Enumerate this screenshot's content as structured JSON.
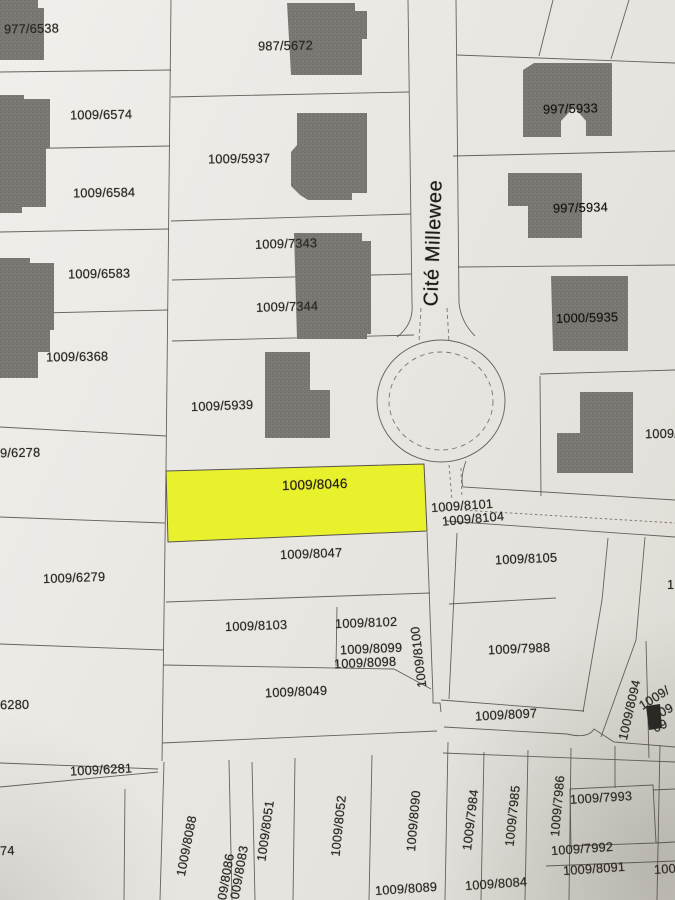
{
  "street": {
    "name": "Cité Millewee"
  },
  "highlight": {
    "parcel": "1009/8046",
    "color": "#e9f02c"
  },
  "labels": {
    "p977_6538": "977/6538",
    "p1009_6574": "1009/6574",
    "p1009_6584": "1009/6584",
    "p1009_6583": "1009/6583",
    "p1009_6368": "1009/6368",
    "p987_5672": "987/5672",
    "p1009_5937": "1009/5937",
    "p1009_7343": "1009/7343",
    "p1009_7344": "1009/7344",
    "p1009_5939": "1009/5939",
    "p997_5933": "997/5933",
    "p997_5934": "997/5934",
    "p1000_5935": "1000/5935",
    "p1009_trunc_right_top": "1009/",
    "p1009_8046": "1009/8046",
    "p1009_8101": "1009/8101",
    "p1009_8104": "1009/8104",
    "p1009_8047": "1009/8047",
    "p1009_8105": "1009/8105",
    "p9_6278": "9/6278",
    "p1009_6279": "1009/6279",
    "p1009_8103": "1009/8103",
    "p1009_8102": "1009/8102",
    "p1009_8099": "1009/8099",
    "p1009_8098": "1009/8098",
    "p1009_8100": "1009/8100",
    "p1009_8049": "1009/8049",
    "p1009_7988": "1009/7988",
    "p6280": "6280",
    "p1009_8094": "1009/8094",
    "p1009_8097": "1009/8097",
    "p1009_6281": "1009/6281",
    "p1_trunc_right_mid": "1",
    "p1009_cluster_a": "1009/",
    "p1009_cluster_b": "009",
    "p1009_cluster_c": "09",
    "p74_trunc": "74",
    "p1009_8088": "1009/8088",
    "p1009_8086": "1009/8086",
    "p1009_8083": "1009/8083",
    "p1009_8051": "1009/8051",
    "p1009_8052": "1009/8052",
    "p1009_8090": "1009/8090",
    "p1009_8089": "1009/8089",
    "p1009_7984": "1009/7984",
    "p1009_7985": "1009/7985",
    "p1009_7986": "1009/7986",
    "p1009_7993": "1009/7993",
    "p1009_7992": "1009/7992",
    "p1009_8091": "1009/8091",
    "p1009_8084": "1009/8084",
    "p1009_trunc_bottom_right": "1009"
  }
}
